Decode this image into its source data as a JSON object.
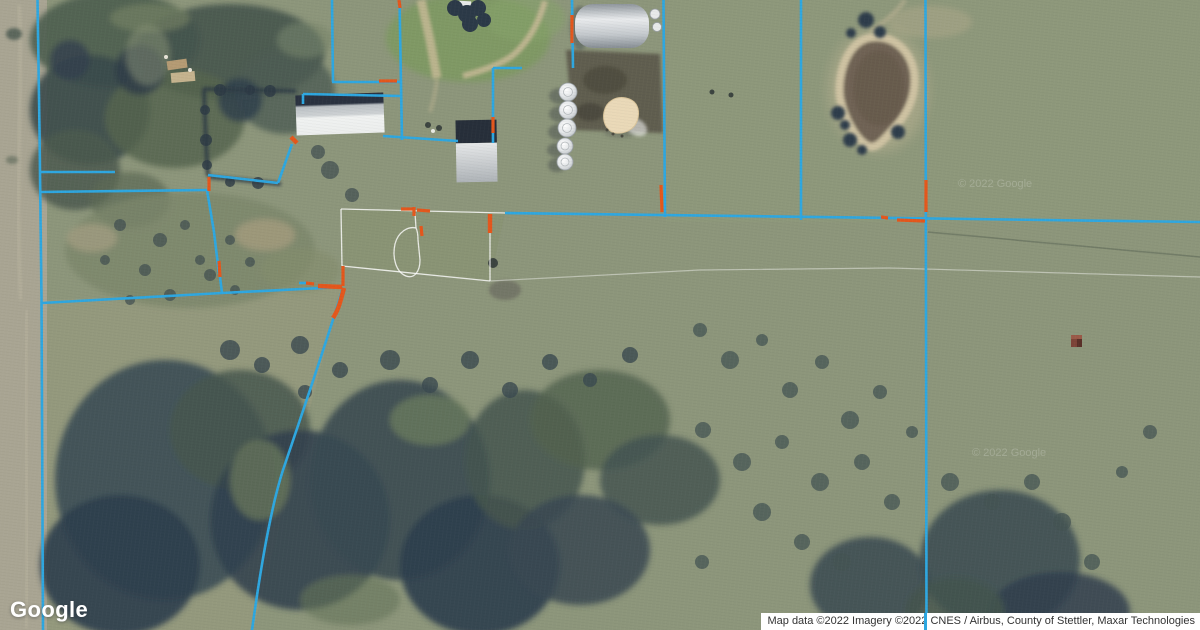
{
  "map": {
    "view_type": "satellite",
    "provider_logo": "Google",
    "imagery_watermark": "© 2022 Google",
    "boundary_color": "#2ea7e0",
    "survey_marker_color": "#e4571c",
    "fence_color": "#ffffff",
    "terrain_base_color": "#8d967b",
    "pond_color": "#6f6355",
    "pond_bank_color": "#cfc3a3"
  },
  "attribution": {
    "text": "Map data ©2022 Imagery ©2022 CNES / Airbus, County of Stettler, Maxar Technologies"
  }
}
